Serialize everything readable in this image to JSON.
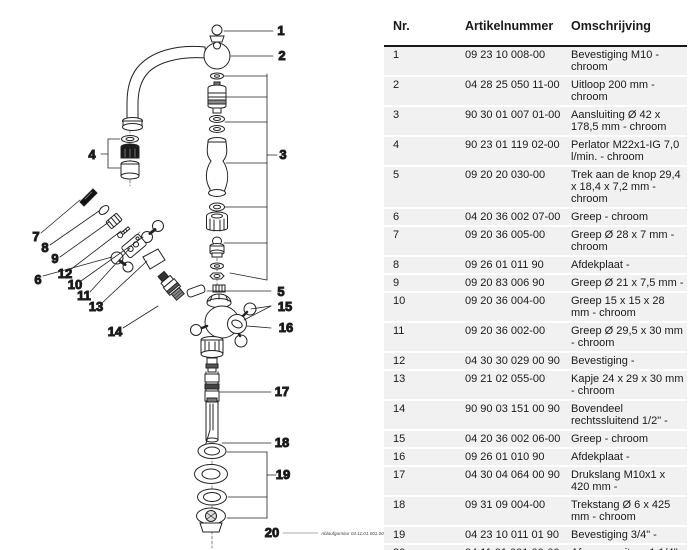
{
  "colors": {
    "line_art": "#222222",
    "table_row_bg": "#f1f1f1",
    "header_rule": "#1a1a1a"
  },
  "diagram": {
    "callouts": [
      "1",
      "2",
      "3",
      "4",
      "5",
      "6",
      "7",
      "8",
      "9",
      "10",
      "11",
      "12",
      "13",
      "14",
      "15",
      "16",
      "17",
      "18",
      "19",
      "20"
    ],
    "annotation": "Ablaufgarnitur 04.11.01.001.00-#"
  },
  "table": {
    "headers": [
      "Nr.",
      "Artikelnummer",
      "Omschrijving"
    ],
    "rows": [
      [
        "1",
        "09 23 10 008-00",
        "Bevestiging M10 - chroom"
      ],
      [
        "2",
        "04 28 25 050 11-00",
        "Uitloop 200 mm - chroom"
      ],
      [
        "3",
        "90 30 01 007 01-00",
        "Aansluiting Ø 42 x 178,5 mm - chroom"
      ],
      [
        "4",
        "90 23 01 119 02-00",
        "Perlator M22x1-IG 7,0 l/min. - chroom"
      ],
      [
        "5",
        "09 20 20 030-00",
        "Trek aan de knop 29,4 x 18,4 x 7,2 mm - chroom"
      ],
      [
        "6",
        "04 20 36 002 07-00",
        "Greep - chroom"
      ],
      [
        "7",
        "09 20 36 005-00",
        "Greep Ø 28 x 7 mm - chroom"
      ],
      [
        "8",
        "09 26 01 011 90",
        "Afdekplaat -"
      ],
      [
        "9",
        "09 20 83 006 90",
        "Greep Ø 21 x 7,5 mm -"
      ],
      [
        "10",
        "09 20 36 004-00",
        "Greep 15 x 15 x 28 mm - chroom"
      ],
      [
        "11",
        "09 20 36 002-00",
        "Greep Ø 29,5 x 30 mm - chroom"
      ],
      [
        "12",
        "04 30 30 029 00 90",
        "Bevestiging -"
      ],
      [
        "13",
        "09 21 02 055-00",
        "Kapje 24 x 29 x 30 mm - chroom"
      ],
      [
        "14",
        "90 90 03 151 00 90",
        "Bovendeel rechtssluitend 1/2\" -"
      ],
      [
        "15",
        "04 20 36 002 06-00",
        "Greep - chroom"
      ],
      [
        "16",
        "09 26 01 010 90",
        "Afdekplaat -"
      ],
      [
        "17",
        "04 30 04 064 00 90",
        "Drukslang M10x1 x 420 mm -"
      ],
      [
        "18",
        "09 31 09 004-00",
        "Trekstang Ø 6 x 425 mm - chroom"
      ],
      [
        "19",
        "04 23 10 011 01 90",
        "Bevestiging 3/4\" -"
      ],
      [
        "20",
        "04 11 01 001 00-00",
        "Afvoergarnituur 1 1/4\" - chroom"
      ]
    ]
  }
}
